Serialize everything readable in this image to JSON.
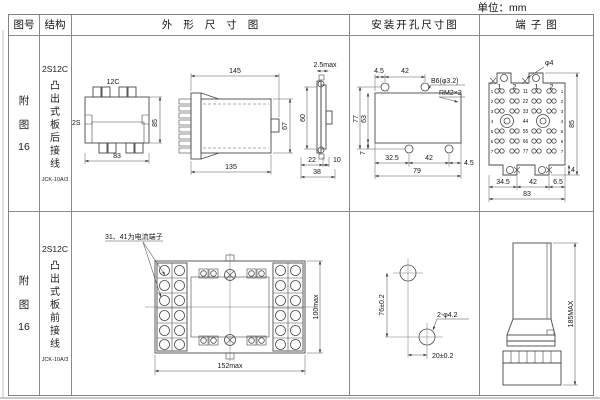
{
  "page": {
    "unit_label": "单位：mm"
  },
  "headers": {
    "fig_no": "图号",
    "structure": "结构",
    "outline": "外形尺寸图",
    "install": "安装开孔尺寸图",
    "terminal": "端子图"
  },
  "rows": [
    {
      "fig_lines": [
        "附",
        "图",
        "16"
      ],
      "model": "2S12C",
      "structure_text": "凸出式板后接线",
      "type_code": "JCK-10A/3",
      "outline": {
        "front": {
          "top_label": "12C",
          "left_label": "2S",
          "height": "85",
          "width": "83"
        },
        "side": {
          "top": "145",
          "bottom": "135",
          "right": "67"
        },
        "profile": {
          "top": "2.5max",
          "left": "60",
          "b1": "22",
          "b2": "10",
          "total": "38"
        }
      },
      "install": {
        "t1": "4.5",
        "t2": "42",
        "hole_label": "B6(φ3.2)",
        "thread_label": "RM2×2",
        "l1": "77",
        "l2": "63",
        "l3": "7",
        "b1": "32.5",
        "b2": "42",
        "b3": "4.5",
        "total": "79"
      },
      "terminal": {
        "hole_label": "φ4",
        "right": "85",
        "tab": "4",
        "b1": "34.5",
        "b2": "42",
        "b3": "6.5",
        "total": "83",
        "cols": [
          "1",
          "2",
          "1",
          "2"
        ],
        "rows": [
          "1",
          "2",
          "3",
          "4",
          "5",
          "6",
          "7"
        ],
        "centers": [
          "11",
          "22",
          "33",
          "44",
          "55",
          "66",
          "77"
        ]
      }
    },
    {
      "fig_lines": [
        "附",
        "图",
        "16"
      ],
      "model": "2S12C",
      "structure_text": "凸出式板前接线",
      "type_code": "JCK-10A/3",
      "outline": {
        "note": "31、41为电流端子",
        "width": "152max",
        "height": "100max"
      },
      "install": {
        "vertical": "76±0.2",
        "horizontal": "20±0.2",
        "hole_label": "2-φ4.2"
      },
      "terminal": {
        "height": "185MAX"
      }
    }
  ]
}
